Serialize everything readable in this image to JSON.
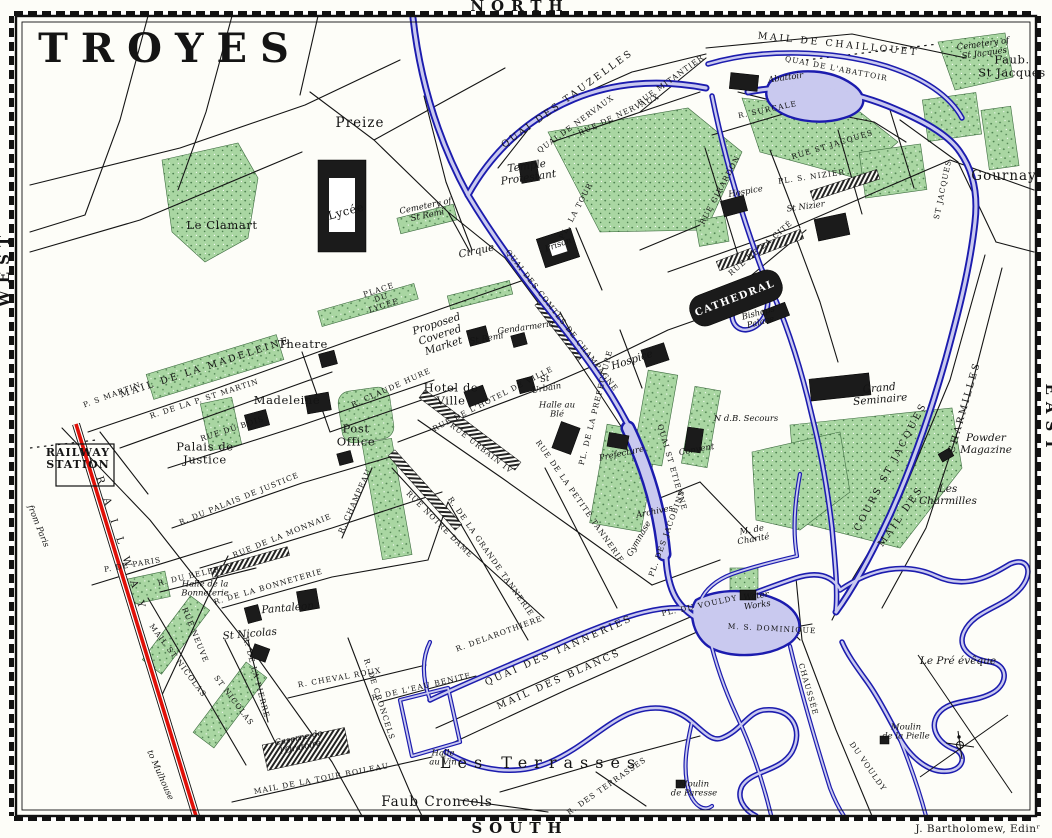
{
  "map_title": "TROYES",
  "colors": {
    "paper": "#fdfdf8",
    "ink": "#141414",
    "water_dark": "#1c1cae",
    "water_light": "#c9c9ef",
    "park": "#a9d6a2",
    "park_dot": "#4e8150",
    "railway_red": "#e01008"
  },
  "labels": [
    {
      "id": "title",
      "t": "TROYES",
      "x": 170,
      "y": 62,
      "r": 0,
      "c": "title"
    },
    {
      "id": "compass-north",
      "t": "NORTH",
      "x": 520,
      "y": 11,
      "r": 0,
      "c": "compass"
    },
    {
      "id": "compass-south",
      "t": "SOUTH",
      "x": 520,
      "y": 833,
      "r": 0,
      "c": "compass"
    },
    {
      "id": "compass-west",
      "t": "WEST",
      "x": 9,
      "y": 268,
      "r": -90,
      "c": "compass"
    },
    {
      "id": "compass-east",
      "t": "EAST",
      "x": 1046,
      "y": 420,
      "r": 90,
      "c": "compass"
    },
    {
      "id": "attribution",
      "t": "J. Bartholomew, Edinʳ",
      "x": 978,
      "y": 832,
      "r": 0,
      "c": "attr"
    },
    {
      "id": "preize",
      "t": "Preize",
      "x": 360,
      "y": 127,
      "r": 0,
      "c": "town"
    },
    {
      "id": "gournay",
      "t": "Gournay",
      "x": 1004,
      "y": 180,
      "r": 0,
      "c": "town"
    },
    {
      "id": "faub-st-jacques",
      "t": "Faub.\nSt Jacques",
      "x": 1012,
      "y": 70,
      "r": 0,
      "c": "place"
    },
    {
      "id": "le-clamart",
      "t": "Le Clamart",
      "x": 222,
      "y": 229,
      "r": 0,
      "c": "place"
    },
    {
      "id": "lycee",
      "t": "Lycée",
      "x": 347,
      "y": 215,
      "r": -15,
      "c": "place"
    },
    {
      "id": "cirque",
      "t": "Cirque",
      "x": 477,
      "y": 254,
      "r": -12,
      "c": "it"
    },
    {
      "id": "place-du-lycee",
      "t": "PLACE\nDU\nLYCÉE",
      "x": 382,
      "y": 300,
      "r": -18,
      "c": "st"
    },
    {
      "id": "theatre",
      "t": "Theatre",
      "x": 303,
      "y": 348,
      "r": 0,
      "c": "place"
    },
    {
      "id": "madeleine",
      "t": "Madeleine",
      "x": 287,
      "y": 404,
      "r": 0,
      "c": "place"
    },
    {
      "id": "hotel-de-ville",
      "t": "Hotel de\nVille",
      "x": 451,
      "y": 398,
      "r": 0,
      "c": "place"
    },
    {
      "id": "post-office",
      "t": "Post\nOffice",
      "x": 356,
      "y": 439,
      "r": 0,
      "c": "place"
    },
    {
      "id": "palais-de-justice",
      "t": "Palais de\nJustice",
      "x": 205,
      "y": 457,
      "r": 0,
      "c": "place"
    },
    {
      "id": "railway-station",
      "t": "RAILWAY\nSTATION",
      "x": 78,
      "y": 462,
      "r": 0,
      "c": "place-b"
    },
    {
      "id": "proposed-market",
      "t": "Proposed\nCovered\nMarket",
      "x": 441,
      "y": 338,
      "r": -18,
      "c": "it"
    },
    {
      "id": "st-remi",
      "t": "St Remi",
      "x": 487,
      "y": 341,
      "r": -10,
      "c": "it-sm"
    },
    {
      "id": "gendarmerie",
      "t": "Gendarmerie",
      "x": 526,
      "y": 330,
      "r": -8,
      "c": "it-sm"
    },
    {
      "id": "temple-protestant",
      "t": "Temple\nProtestant",
      "x": 528,
      "y": 175,
      "r": -8,
      "c": "it"
    },
    {
      "id": "prison",
      "t": "Prison",
      "x": 559,
      "y": 247,
      "r": -20,
      "c": "it-sm"
    },
    {
      "id": "pl-la-tour",
      "t": "PL. LA TOUR",
      "x": 578,
      "y": 212,
      "r": -62,
      "c": "st"
    },
    {
      "id": "cathedral",
      "t": "CATHEDRAL",
      "x": 736,
      "y": 301,
      "r": -21,
      "c": "cath"
    },
    {
      "id": "bishops-palace",
      "t": "Bishops\nPalace",
      "x": 760,
      "y": 320,
      "r": -15,
      "c": "it-sm"
    },
    {
      "id": "hospice-nizier",
      "t": "Hospice",
      "x": 746,
      "y": 194,
      "r": -10,
      "c": "it-sm"
    },
    {
      "id": "st-nizier",
      "t": "St Nizier",
      "x": 806,
      "y": 209,
      "r": -8,
      "c": "it-sm"
    },
    {
      "id": "pl-s-nizier",
      "t": "PL. S. NIZIER",
      "x": 812,
      "y": 179,
      "r": -8,
      "c": "st"
    },
    {
      "id": "hospice-center",
      "t": "Hospice",
      "x": 633,
      "y": 363,
      "r": -18,
      "c": "it"
    },
    {
      "id": "grand-seminaire",
      "t": "Grand\nSeminaire",
      "x": 880,
      "y": 397,
      "r": -5,
      "c": "it"
    },
    {
      "id": "powder-magazine",
      "t": "Powder\nMagazine",
      "x": 986,
      "y": 447,
      "r": 0,
      "c": "it"
    },
    {
      "id": "les-charmilles",
      "t": "Les\nCharmilles",
      "x": 948,
      "y": 498,
      "r": 0,
      "c": "it"
    },
    {
      "id": "le-pre-eveque",
      "t": "Le Pré évêque",
      "x": 958,
      "y": 664,
      "r": 0,
      "c": "it"
    },
    {
      "id": "moulin-pielle",
      "t": "Moulin\nde la Pielle",
      "x": 906,
      "y": 734,
      "r": 0,
      "c": "it-sm"
    },
    {
      "id": "moulin-paresse",
      "t": "Moulin\nde Paresse",
      "x": 694,
      "y": 791,
      "r": 0,
      "c": "it-sm"
    },
    {
      "id": "water-works",
      "t": "Water\nWorks",
      "x": 757,
      "y": 603,
      "r": -8,
      "c": "it-sm"
    },
    {
      "id": "m-de-charite",
      "t": "M. de\nCharité",
      "x": 753,
      "y": 537,
      "r": -10,
      "c": "it-sm"
    },
    {
      "id": "ndb-secours",
      "t": "N d.B. Secours",
      "x": 746,
      "y": 421,
      "r": 0,
      "c": "it-sm"
    },
    {
      "id": "convent",
      "t": "Convent",
      "x": 697,
      "y": 452,
      "r": -10,
      "c": "it-sm"
    },
    {
      "id": "archives",
      "t": "Archives",
      "x": 655,
      "y": 514,
      "r": -12,
      "c": "it-sm"
    },
    {
      "id": "pl-des-jacobins",
      "t": "PL. DES JACOBINS",
      "x": 669,
      "y": 534,
      "r": -70,
      "c": "st"
    },
    {
      "id": "gymnase",
      "t": "Gymnase",
      "x": 641,
      "y": 540,
      "r": -60,
      "c": "it-sm"
    },
    {
      "id": "prefecture",
      "t": "Prefecture",
      "x": 622,
      "y": 456,
      "r": -12,
      "c": "it-sm"
    },
    {
      "id": "pl-de-la-prefecture",
      "t": "PL. DE LA PREFECTURE",
      "x": 598,
      "y": 408,
      "r": -76,
      "c": "st"
    },
    {
      "id": "les-terrasses",
      "t": "Les Terrasses",
      "x": 541,
      "y": 768,
      "r": 0,
      "c": "terr"
    },
    {
      "id": "faub-croncels",
      "t": "Faub Croncels",
      "x": 437,
      "y": 806,
      "r": 0,
      "c": "town"
    },
    {
      "id": "halle-au-vin",
      "t": "Halle\nau Vin",
      "x": 443,
      "y": 760,
      "r": 0,
      "c": "it-sm"
    },
    {
      "id": "halle-bonneterie",
      "t": "Halle de la\nBonneterie",
      "x": 205,
      "y": 591,
      "r": 0,
      "c": "it-sm"
    },
    {
      "id": "pantaleon",
      "t": "Pantaleon",
      "x": 288,
      "y": 611,
      "r": -5,
      "c": "it"
    },
    {
      "id": "st-nicolas",
      "t": "St Nicolas",
      "x": 250,
      "y": 637,
      "r": -5,
      "c": "it"
    },
    {
      "id": "caserne-oratoire",
      "t": "Caserne de\nl'Oratoire",
      "x": 300,
      "y": 745,
      "r": -12,
      "c": "it-sm"
    },
    {
      "id": "halle-au-ble",
      "t": "Halle au\nBlé",
      "x": 557,
      "y": 412,
      "r": 0,
      "c": "it-sm"
    },
    {
      "id": "st-urbain",
      "t": "St\nUrbain",
      "x": 546,
      "y": 386,
      "r": -10,
      "c": "it-sm"
    },
    {
      "id": "abattoir",
      "t": "Abattoir",
      "x": 786,
      "y": 80,
      "r": -8,
      "c": "it-sm"
    },
    {
      "id": "cemetery-st-jacques",
      "t": "Cemetery of\nSt Jacques",
      "x": 984,
      "y": 51,
      "r": -8,
      "c": "it-sm"
    },
    {
      "id": "cemetery-st-remi",
      "t": "Cemetery of\nSt Remi",
      "x": 427,
      "y": 213,
      "r": -12,
      "c": "it-sm"
    },
    {
      "id": "from-paris",
      "t": "from Paris",
      "x": 36,
      "y": 527,
      "r": 68,
      "c": "it-sm"
    },
    {
      "id": "to-mulhouse",
      "t": "to Mulhouse",
      "x": 158,
      "y": 776,
      "r": 66,
      "c": "it-sm"
    },
    {
      "id": "railway-word",
      "t": "RAILWAY",
      "x": 120,
      "y": 550,
      "r": 72,
      "c": "rw"
    },
    {
      "id": "quai-des-tauzelles",
      "t": "QUAI DES TAUZELLES",
      "x": 569,
      "y": 101,
      "r": -36,
      "c": "st-lg"
    },
    {
      "id": "quai-de-nervaux",
      "t": "QUAI DE NERVAUX",
      "x": 577,
      "y": 126,
      "r": -36,
      "c": "st"
    },
    {
      "id": "rue-de-nervaux",
      "t": "RUE DE NERVAUX",
      "x": 620,
      "y": 117,
      "r": -25,
      "c": "st"
    },
    {
      "id": "mail-de-chaillouet",
      "t": "MAIL DE CHAILLOUET",
      "x": 838,
      "y": 47,
      "r": 6,
      "c": "st-lg"
    },
    {
      "id": "quai-de-l-abattoir",
      "t": "QUAI DE L'ABATTOIR",
      "x": 836,
      "y": 71,
      "r": 11,
      "c": "st"
    },
    {
      "id": "rue-st-jacques",
      "t": "RUE ST JACQUES",
      "x": 833,
      "y": 147,
      "r": -17,
      "c": "st"
    },
    {
      "id": "st-jacques-vertical",
      "t": "ST JACQUES",
      "x": 945,
      "y": 190,
      "r": -78,
      "c": "st"
    },
    {
      "id": "cours-st-jacques",
      "t": "COURS ST JACQUES",
      "x": 893,
      "y": 468,
      "r": -62,
      "c": "st-lg"
    },
    {
      "id": "mail-des",
      "t": "MAIL DES",
      "x": 903,
      "y": 518,
      "r": -55,
      "c": "st-lg"
    },
    {
      "id": "charmilles-vertical",
      "t": "CHARMILLES",
      "x": 967,
      "y": 408,
      "r": -74,
      "c": "st-lg"
    },
    {
      "id": "quai-des-comtes",
      "t": "QUAI DES COMTES DE CHAMPAGNE",
      "x": 560,
      "y": 322,
      "r": 52,
      "c": "st"
    },
    {
      "id": "quai-st-etienne",
      "t": "QUAI ST ETIENNE",
      "x": 670,
      "y": 468,
      "r": 74,
      "c": "st"
    },
    {
      "id": "rue-urbain-iv",
      "t": "RUE URBAIN IV",
      "x": 480,
      "y": 450,
      "r": 38,
      "c": "st"
    },
    {
      "id": "rue-notre-dame",
      "t": "RUE NOTRE DAME",
      "x": 438,
      "y": 526,
      "r": 45,
      "c": "st"
    },
    {
      "id": "rue-de-la-monnaie",
      "t": "RUE DE LA MONNAIE",
      "x": 283,
      "y": 538,
      "r": -22,
      "c": "st"
    },
    {
      "id": "r-du-palais-de-justice",
      "t": "R. DU PALAIS DE JUSTICE",
      "x": 240,
      "y": 501,
      "r": -22,
      "c": "st"
    },
    {
      "id": "rue-du-bois",
      "t": "RUE DU BOIS",
      "x": 233,
      "y": 431,
      "r": -18,
      "c": "st"
    },
    {
      "id": "r-de-la-p-st-martin",
      "t": "R. DE LA P. ST MARTIN",
      "x": 205,
      "y": 401,
      "r": -18,
      "c": "st"
    },
    {
      "id": "mail-de-la-madeleine",
      "t": "MAIL DE LA MADELEINE",
      "x": 206,
      "y": 370,
      "r": -18,
      "c": "st-lg"
    },
    {
      "id": "p-s-martin",
      "t": "P. S MARTIN",
      "x": 113,
      "y": 397,
      "r": -20,
      "c": "st"
    },
    {
      "id": "p-de-paris",
      "t": "P. DE PARIS",
      "x": 133,
      "y": 567,
      "r": -10,
      "c": "st"
    },
    {
      "id": "r-du-belfroy",
      "t": "R. DU BELFROY",
      "x": 196,
      "y": 577,
      "r": -13,
      "c": "st"
    },
    {
      "id": "r-de-la-bonneterie",
      "t": "R. DE LA BONNETERIE",
      "x": 269,
      "y": 589,
      "r": -16,
      "c": "st"
    },
    {
      "id": "rue-neuve",
      "t": "RUE NEUVE",
      "x": 193,
      "y": 636,
      "r": 68,
      "c": "st"
    },
    {
      "id": "mail-st-nicolas",
      "t": "MAIL ST NICOLAS",
      "x": 176,
      "y": 662,
      "r": 53,
      "c": "st"
    },
    {
      "id": "st-nicolas-vertical",
      "t": "ST NICOLAS",
      "x": 232,
      "y": 702,
      "r": 53,
      "c": "st"
    },
    {
      "id": "r-de-la-pierre",
      "t": "R. DE LA PIERRE",
      "x": 254,
      "y": 678,
      "r": 75,
      "c": "st"
    },
    {
      "id": "r-cheval-roux",
      "t": "R. CHEVAL ROUX",
      "x": 340,
      "y": 680,
      "r": -10,
      "c": "st"
    },
    {
      "id": "r-de-croncels",
      "t": "R. DE CRONCELS",
      "x": 377,
      "y": 700,
      "r": 72,
      "c": "st"
    },
    {
      "id": "r-eau-benite",
      "t": "R. DE L'EAU BENITE",
      "x": 422,
      "y": 689,
      "r": -13,
      "c": "st"
    },
    {
      "id": "mail-tour-boileau",
      "t": "MAIL DE LA TOUR BOILEAU",
      "x": 322,
      "y": 781,
      "r": -11,
      "c": "st"
    },
    {
      "id": "quai-des-tanneries",
      "t": "QUAI DES TANNERIES",
      "x": 560,
      "y": 653,
      "r": -24,
      "c": "st-lg"
    },
    {
      "id": "mail-des-blancs",
      "t": "MAIL DES BLANCS",
      "x": 560,
      "y": 682,
      "r": -24,
      "c": "st-lg"
    },
    {
      "id": "r-delarothiere",
      "t": "R. DELAROTHIERE",
      "x": 500,
      "y": 636,
      "r": -20,
      "c": "st"
    },
    {
      "id": "chaussee",
      "t": "CHAUSSÉE",
      "x": 806,
      "y": 690,
      "r": 74,
      "c": "st"
    },
    {
      "id": "du-vouldy",
      "t": "DU VOULDY",
      "x": 866,
      "y": 768,
      "r": 55,
      "c": "st"
    },
    {
      "id": "m-s-dominique",
      "t": "M. S. DOMINIQUE",
      "x": 772,
      "y": 631,
      "r": 3,
      "c": "st"
    },
    {
      "id": "pl-du-vouldy",
      "t": "PL. DU VOULDY",
      "x": 700,
      "y": 608,
      "r": -12,
      "c": "st"
    },
    {
      "id": "rue-de-la-cite",
      "t": "RUE DE LA CITÉ",
      "x": 762,
      "y": 250,
      "r": -40,
      "c": "st"
    },
    {
      "id": "rue-girardon",
      "t": "RUE GIRARDON",
      "x": 722,
      "y": 191,
      "r": -62,
      "c": "st"
    },
    {
      "id": "r-surcale",
      "t": "R. SURCALE",
      "x": 768,
      "y": 112,
      "r": -12,
      "c": "st"
    },
    {
      "id": "rue-mitantier",
      "t": "RUE MITANTIER",
      "x": 672,
      "y": 82,
      "r": -36,
      "c": "st"
    },
    {
      "id": "r-grande-tannerie",
      "t": "R. DE LA GRANDE TANNERIE",
      "x": 489,
      "y": 558,
      "r": 55,
      "c": "st"
    },
    {
      "id": "rue-petite-tannerie",
      "t": "RUE DE LA PETITE TANNERIE",
      "x": 578,
      "y": 503,
      "r": 55,
      "c": "st"
    },
    {
      "id": "r-claude-hure",
      "t": "R. CLAUDE HURE",
      "x": 392,
      "y": 390,
      "r": -24,
      "c": "st"
    },
    {
      "id": "rue-hotel-de-ville",
      "t": "RUE DE L'HOTEL DE VILLE",
      "x": 494,
      "y": 401,
      "r": -27,
      "c": "st"
    },
    {
      "id": "r-champeau",
      "t": "R. CHAMPEAU",
      "x": 357,
      "y": 502,
      "r": -66,
      "c": "st"
    },
    {
      "id": "r-des-terrasses",
      "t": "R. DES TERRASSES",
      "x": 608,
      "y": 788,
      "r": -35,
      "c": "st"
    }
  ]
}
